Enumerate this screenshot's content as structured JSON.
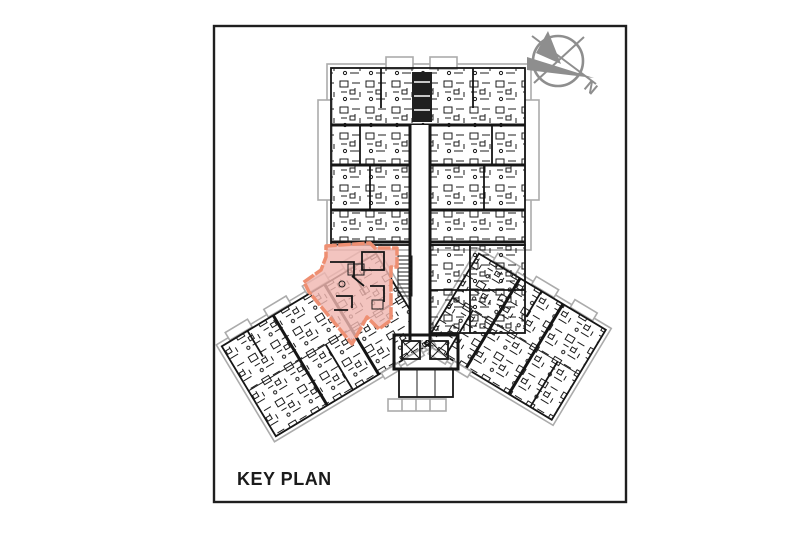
{
  "labels": {
    "key_plan": "KEY PLAN"
  },
  "compass": {
    "label": "N",
    "color": "#8e8e8e"
  },
  "highlight": {
    "fill": "#f0b7b1",
    "stroke": "#ee8f72"
  },
  "plan": {
    "ink": "#1a1a1a",
    "muted": "#ababab",
    "background": "#ffffff",
    "frame_border": "#1f1f1f"
  }
}
